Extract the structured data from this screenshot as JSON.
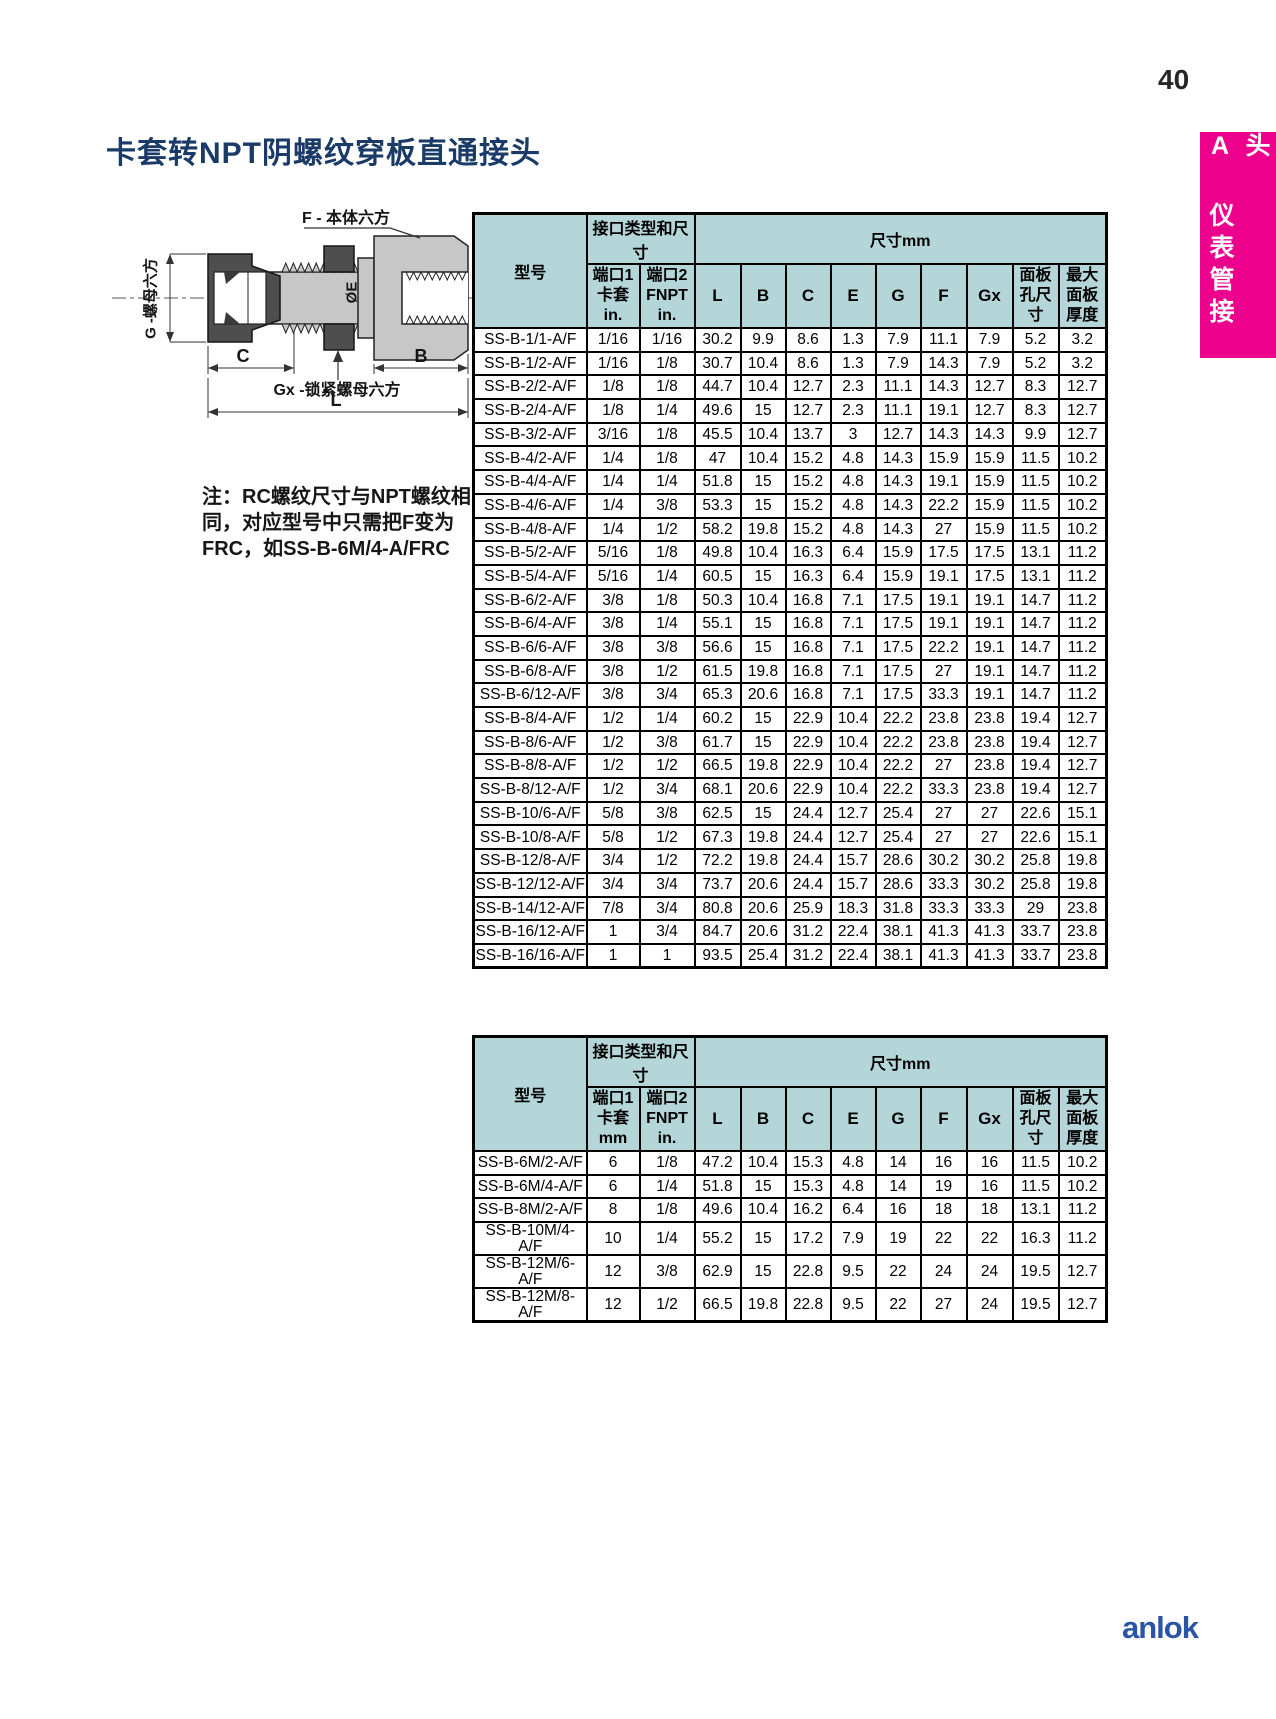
{
  "page": {
    "number": "40",
    "side_tab": "A 仪表管接头",
    "title": "卡套转NPT阴螺纹穿板直通接头",
    "note_lines": [
      "注：RC螺纹尺寸与NPT螺纹相",
      "同，对应型号中只需把F变为",
      "FRC，如SS-B-6M/4-A/FRC"
    ],
    "logo": "anlok"
  },
  "colors": {
    "title_navy": "#1a3a68",
    "tab_magenta": "#ec008c",
    "header_teal": "#b5d6d9",
    "logo_blue": "#2b54a6"
  },
  "drawing": {
    "labels": {
      "body_hex": "F - 本体六方",
      "nut_hex": "G -螺母六方",
      "bore": "ØE",
      "dim_c": "C",
      "dim_b": "B",
      "lock_nut_hex": "Gx -锁紧螺母六方",
      "dim_l": "L"
    }
  },
  "tables": [
    {
      "header": {
        "model": "型号",
        "port_group": "接口类型和尺寸",
        "dim_group": "尺寸mm",
        "port1_lines": [
          "端口1",
          "卡套",
          "in."
        ],
        "port2_lines": [
          "端口2",
          "FNPT",
          "in."
        ],
        "dims": [
          "L",
          "B",
          "C",
          "E",
          "G",
          "F",
          "Gx"
        ],
        "panel_lines": [
          "面板",
          "孔尺",
          "寸"
        ],
        "thickness_lines": [
          "最大",
          "面板",
          "厚度"
        ]
      },
      "rows": [
        [
          "SS-B-1/1-A/F",
          "1/16",
          "1/16",
          "30.2",
          "9.9",
          "8.6",
          "1.3",
          "7.9",
          "11.1",
          "7.9",
          "5.2",
          "3.2"
        ],
        [
          "SS-B-1/2-A/F",
          "1/16",
          "1/8",
          "30.7",
          "10.4",
          "8.6",
          "1.3",
          "7.9",
          "14.3",
          "7.9",
          "5.2",
          "3.2"
        ],
        [
          "SS-B-2/2-A/F",
          "1/8",
          "1/8",
          "44.7",
          "10.4",
          "12.7",
          "2.3",
          "11.1",
          "14.3",
          "12.7",
          "8.3",
          "12.7"
        ],
        [
          "SS-B-2/4-A/F",
          "1/8",
          "1/4",
          "49.6",
          "15",
          "12.7",
          "2.3",
          "11.1",
          "19.1",
          "12.7",
          "8.3",
          "12.7"
        ],
        [
          "SS-B-3/2-A/F",
          "3/16",
          "1/8",
          "45.5",
          "10.4",
          "13.7",
          "3",
          "12.7",
          "14.3",
          "14.3",
          "9.9",
          "12.7"
        ],
        [
          "SS-B-4/2-A/F",
          "1/4",
          "1/8",
          "47",
          "10.4",
          "15.2",
          "4.8",
          "14.3",
          "15.9",
          "15.9",
          "11.5",
          "10.2"
        ],
        [
          "SS-B-4/4-A/F",
          "1/4",
          "1/4",
          "51.8",
          "15",
          "15.2",
          "4.8",
          "14.3",
          "19.1",
          "15.9",
          "11.5",
          "10.2"
        ],
        [
          "SS-B-4/6-A/F",
          "1/4",
          "3/8",
          "53.3",
          "15",
          "15.2",
          "4.8",
          "14.3",
          "22.2",
          "15.9",
          "11.5",
          "10.2"
        ],
        [
          "SS-B-4/8-A/F",
          "1/4",
          "1/2",
          "58.2",
          "19.8",
          "15.2",
          "4.8",
          "14.3",
          "27",
          "15.9",
          "11.5",
          "10.2"
        ],
        [
          "SS-B-5/2-A/F",
          "5/16",
          "1/8",
          "49.8",
          "10.4",
          "16.3",
          "6.4",
          "15.9",
          "17.5",
          "17.5",
          "13.1",
          "11.2"
        ],
        [
          "SS-B-5/4-A/F",
          "5/16",
          "1/4",
          "60.5",
          "15",
          "16.3",
          "6.4",
          "15.9",
          "19.1",
          "17.5",
          "13.1",
          "11.2"
        ],
        [
          "SS-B-6/2-A/F",
          "3/8",
          "1/8",
          "50.3",
          "10.4",
          "16.8",
          "7.1",
          "17.5",
          "19.1",
          "19.1",
          "14.7",
          "11.2"
        ],
        [
          "SS-B-6/4-A/F",
          "3/8",
          "1/4",
          "55.1",
          "15",
          "16.8",
          "7.1",
          "17.5",
          "19.1",
          "19.1",
          "14.7",
          "11.2"
        ],
        [
          "SS-B-6/6-A/F",
          "3/8",
          "3/8",
          "56.6",
          "15",
          "16.8",
          "7.1",
          "17.5",
          "22.2",
          "19.1",
          "14.7",
          "11.2"
        ],
        [
          "SS-B-6/8-A/F",
          "3/8",
          "1/2",
          "61.5",
          "19.8",
          "16.8",
          "7.1",
          "17.5",
          "27",
          "19.1",
          "14.7",
          "11.2"
        ],
        [
          "SS-B-6/12-A/F",
          "3/8",
          "3/4",
          "65.3",
          "20.6",
          "16.8",
          "7.1",
          "17.5",
          "33.3",
          "19.1",
          "14.7",
          "11.2"
        ],
        [
          "SS-B-8/4-A/F",
          "1/2",
          "1/4",
          "60.2",
          "15",
          "22.9",
          "10.4",
          "22.2",
          "23.8",
          "23.8",
          "19.4",
          "12.7"
        ],
        [
          "SS-B-8/6-A/F",
          "1/2",
          "3/8",
          "61.7",
          "15",
          "22.9",
          "10.4",
          "22.2",
          "23.8",
          "23.8",
          "19.4",
          "12.7"
        ],
        [
          "SS-B-8/8-A/F",
          "1/2",
          "1/2",
          "66.5",
          "19.8",
          "22.9",
          "10.4",
          "22.2",
          "27",
          "23.8",
          "19.4",
          "12.7"
        ],
        [
          "SS-B-8/12-A/F",
          "1/2",
          "3/4",
          "68.1",
          "20.6",
          "22.9",
          "10.4",
          "22.2",
          "33.3",
          "23.8",
          "19.4",
          "12.7"
        ],
        [
          "SS-B-10/6-A/F",
          "5/8",
          "3/8",
          "62.5",
          "15",
          "24.4",
          "12.7",
          "25.4",
          "27",
          "27",
          "22.6",
          "15.1"
        ],
        [
          "SS-B-10/8-A/F",
          "5/8",
          "1/2",
          "67.3",
          "19.8",
          "24.4",
          "12.7",
          "25.4",
          "27",
          "27",
          "22.6",
          "15.1"
        ],
        [
          "SS-B-12/8-A/F",
          "3/4",
          "1/2",
          "72.2",
          "19.8",
          "24.4",
          "15.7",
          "28.6",
          "30.2",
          "30.2",
          "25.8",
          "19.8"
        ],
        [
          "SS-B-12/12-A/F",
          "3/4",
          "3/4",
          "73.7",
          "20.6",
          "24.4",
          "15.7",
          "28.6",
          "33.3",
          "30.2",
          "25.8",
          "19.8"
        ],
        [
          "SS-B-14/12-A/F",
          "7/8",
          "3/4",
          "80.8",
          "20.6",
          "25.9",
          "18.3",
          "31.8",
          "33.3",
          "33.3",
          "29",
          "23.8"
        ],
        [
          "SS-B-16/12-A/F",
          "1",
          "3/4",
          "84.7",
          "20.6",
          "31.2",
          "22.4",
          "38.1",
          "41.3",
          "41.3",
          "33.7",
          "23.8"
        ],
        [
          "SS-B-16/16-A/F",
          "1",
          "1",
          "93.5",
          "25.4",
          "31.2",
          "22.4",
          "38.1",
          "41.3",
          "41.3",
          "33.7",
          "23.8"
        ]
      ]
    },
    {
      "header": {
        "model": "型号",
        "port_group": "接口类型和尺寸",
        "dim_group": "尺寸mm",
        "port1_lines": [
          "端口1",
          "卡套",
          "mm"
        ],
        "port2_lines": [
          "端口2",
          "FNPT",
          "in."
        ],
        "dims": [
          "L",
          "B",
          "C",
          "E",
          "G",
          "F",
          "Gx"
        ],
        "panel_lines": [
          "面板",
          "孔尺",
          "寸"
        ],
        "thickness_lines": [
          "最大",
          "面板",
          "厚度"
        ]
      },
      "rows": [
        [
          "SS-B-6M/2-A/F",
          "6",
          "1/8",
          "47.2",
          "10.4",
          "15.3",
          "4.8",
          "14",
          "16",
          "16",
          "11.5",
          "10.2"
        ],
        [
          "SS-B-6M/4-A/F",
          "6",
          "1/4",
          "51.8",
          "15",
          "15.3",
          "4.8",
          "14",
          "19",
          "16",
          "11.5",
          "10.2"
        ],
        [
          "SS-B-8M/2-A/F",
          "8",
          "1/8",
          "49.6",
          "10.4",
          "16.2",
          "6.4",
          "16",
          "18",
          "18",
          "13.1",
          "11.2"
        ],
        [
          "SS-B-10M/4-A/F",
          "10",
          "1/4",
          "55.2",
          "15",
          "17.2",
          "7.9",
          "19",
          "22",
          "22",
          "16.3",
          "11.2"
        ],
        [
          "SS-B-12M/6-A/F",
          "12",
          "3/8",
          "62.9",
          "15",
          "22.8",
          "9.5",
          "22",
          "24",
          "24",
          "19.5",
          "12.7"
        ],
        [
          "SS-B-12M/8-A/F",
          "12",
          "1/2",
          "66.5",
          "19.8",
          "22.8",
          "9.5",
          "22",
          "27",
          "24",
          "19.5",
          "12.7"
        ]
      ]
    }
  ]
}
